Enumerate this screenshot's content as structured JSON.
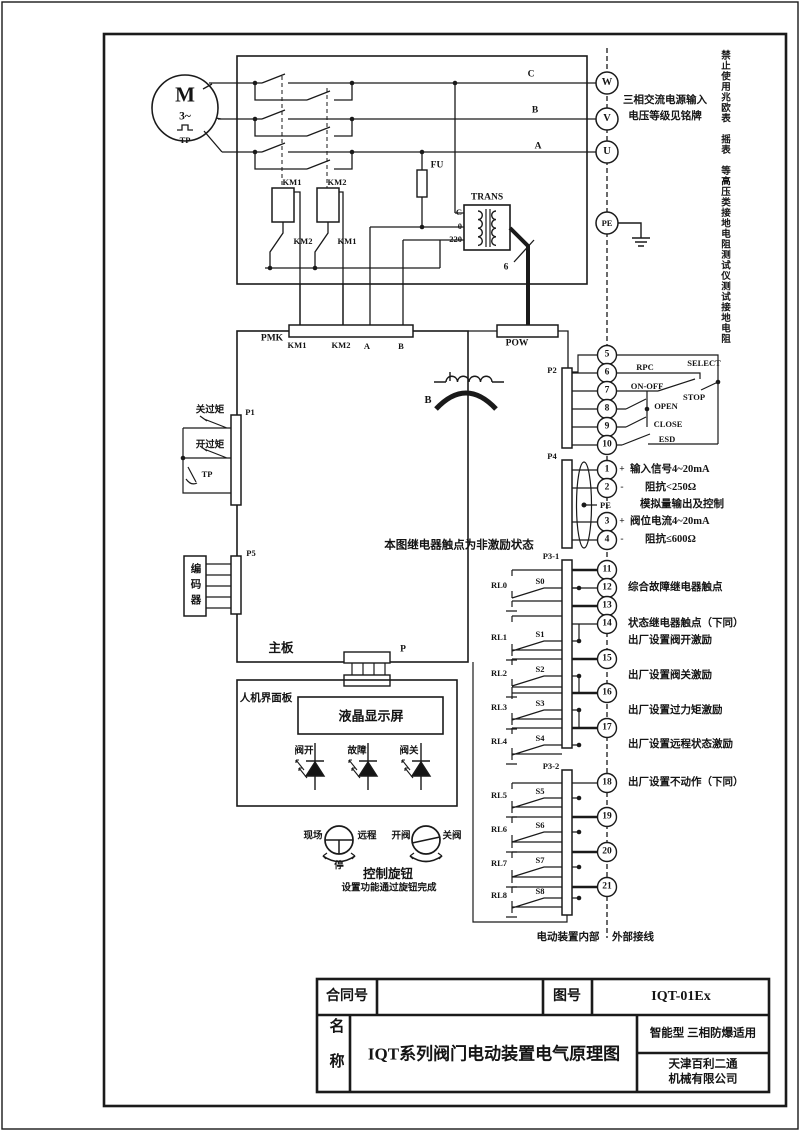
{
  "titleblock": {
    "contract_label": "合同号",
    "drawing_no_label": "图号",
    "drawing_no": "IQT-01Ex",
    "name_label": "名称",
    "title": "IQT系列阀门电动装置电气原理图",
    "type_note": "智能型  三相防爆适用",
    "company_line1": "天津百利二通",
    "company_line2": "机械有限公司"
  },
  "notes": {
    "megger_warning": "禁止使用兆欧表　摇表　等高压类接地电阻测试仪测试接地电阻",
    "power_input_1": "三相交流电源输入",
    "power_input_2": "电压等级见铭牌",
    "relay_state": "本图继电器触点为非激励状态",
    "internal": "电动装置内部",
    "external": "外部接线",
    "wire_count": "6"
  },
  "motor": {
    "symbol": "M",
    "phases": "3~",
    "thermal": "TP"
  },
  "top_circuit": {
    "km1": "KM1",
    "km2": "KM2",
    "km2_aux": "KM2",
    "km1_aux": "KM1",
    "fuse": "FU",
    "trans": "TRANS",
    "tap_c": "C",
    "tap_0": "0",
    "tap_220": "220",
    "phase_c": "C",
    "phase_b": "B",
    "phase_a": "A"
  },
  "connectors": {
    "pmk": "PMK",
    "pmk_pins": [
      "KM1",
      "KM2",
      "A",
      "B"
    ],
    "pow": "POW",
    "p1": "P1",
    "p2": "P2",
    "p4": "P4",
    "p5": "P5",
    "p3_1": "P3-1",
    "p3_2": "P3-2",
    "p": "P",
    "b_coil": "B"
  },
  "left_side": {
    "close_torque": "关过矩",
    "open_torque": "开过矩",
    "tp": "TP",
    "encoder": "编码器",
    "mainboard": "主板"
  },
  "hmi": {
    "panel": "人机界面板",
    "lcd": "液晶显示屏",
    "led_open": "阀开",
    "led_fault": "故障",
    "led_close": "阀关",
    "local": "现场",
    "remote": "远程",
    "stop": "停",
    "open_valve": "开阀",
    "close_valve": "关阀",
    "knob": "控制旋钮",
    "knob_note": "设置功能通过旋钮完成"
  },
  "p2_labels": {
    "select": "SELECT",
    "rpc": "RPC",
    "onoff": "ON-OFF",
    "stop": "STOP",
    "open": "OPEN",
    "close": "CLOSE",
    "esd": "ESD"
  },
  "pwr_terms": [
    "W",
    "V",
    "U"
  ],
  "pe_term": "PE",
  "p2_terms": [
    "5",
    "6",
    "7",
    "8",
    "9",
    "10"
  ],
  "p4_terms": [
    "1",
    "2",
    "3",
    "4"
  ],
  "p4_pe": "PE",
  "p31_terms": [
    "11",
    "12",
    "13",
    "14",
    "15",
    "16",
    "17"
  ],
  "p32_terms": [
    "18",
    "19",
    "20",
    "21"
  ],
  "relays": [
    {
      "name": "RL0",
      "sw": "S0"
    },
    {
      "name": "RL1",
      "sw": "S1"
    },
    {
      "name": "RL2",
      "sw": "S2"
    },
    {
      "name": "RL3",
      "sw": "S3"
    },
    {
      "name": "RL4",
      "sw": "S4"
    },
    {
      "name": "RL5",
      "sw": "S5"
    },
    {
      "name": "RL6",
      "sw": "S6"
    },
    {
      "name": "RL7",
      "sw": "S7"
    },
    {
      "name": "RL8",
      "sw": "S8"
    }
  ],
  "annotations": {
    "plus": "+",
    "minus": "-",
    "sig_in": "输入信号4~20mA",
    "imp_in": "阻抗<250Ω",
    "analog": "模拟量输出及控制",
    "pos_cur": "阀位电流4~20mA",
    "imp_out": "阻抗≤600Ω",
    "fault": "综合故障继电器触点",
    "status": "状态继电器触点（下同）",
    "exc_open": "出厂设置阀开激励",
    "exc_close": "出厂设置阀关激励",
    "exc_torque": "出厂设置过力矩激励",
    "exc_remote": "出厂设置远程状态激励",
    "no_action": "出厂设置不动作（下同）"
  }
}
